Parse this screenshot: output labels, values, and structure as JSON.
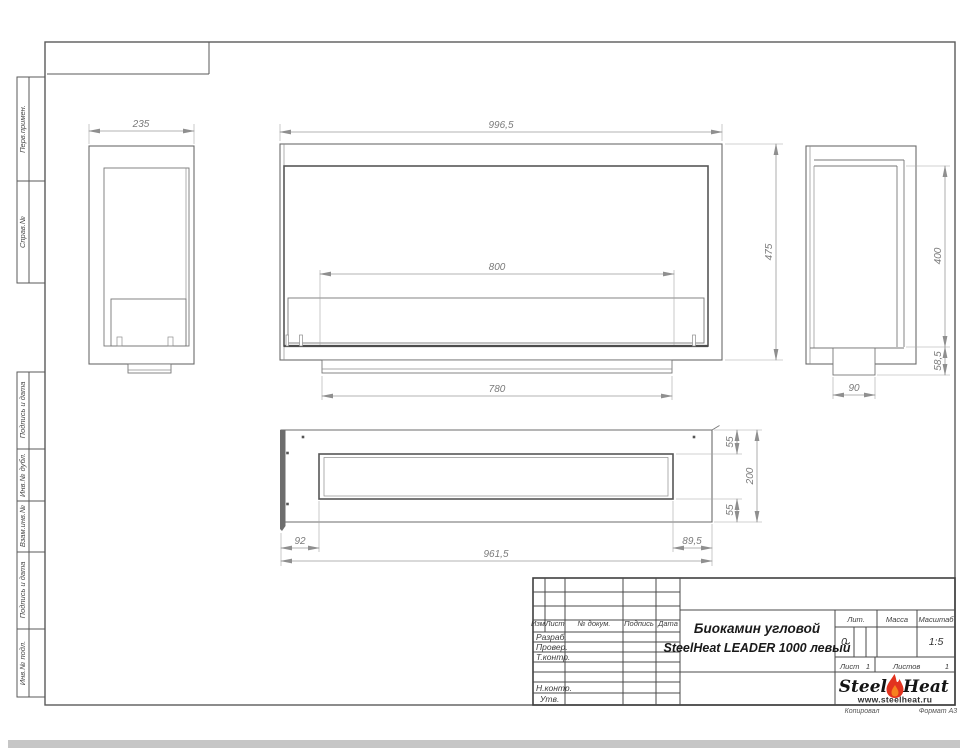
{
  "sidebar": {
    "labels": [
      "Перв.примен.",
      "Справ.№",
      "Подпись и дата",
      "Инв.№ дубл.",
      "Взам.инв.№",
      "Подпись и дата",
      "Инв.№ подл."
    ]
  },
  "dims": {
    "left_width": "235",
    "front_width": "996,5",
    "front_burner": "800",
    "front_height": "475",
    "front_base": "780",
    "side_height": "400",
    "side_bottom": "58,5",
    "side_foot": "90",
    "plan_top": "55",
    "plan_depth": "200",
    "plan_bottom": "55",
    "plan_left": "92",
    "plan_length": "961,5",
    "plan_right": "89,5"
  },
  "stamp": {
    "cols": {
      "izm": "Изм.",
      "list": "Лист",
      "doc": "№ докум.",
      "sign": "Подпись",
      "date": "Дата"
    },
    "rows": {
      "razrab": "Разраб.",
      "prover": "Провер.",
      "tkontr": "Т.контр.",
      "nkontr": "Н.контр.",
      "utv": "Утв."
    },
    "title1": "Биокамин угловой",
    "title2": "SteelHeat LEADER 1000 левый",
    "lit_label": "Лит.",
    "lit_value": "0",
    "mass_label": "Масса",
    "scale_label": "Масштаб",
    "scale_value": "1:5",
    "sheet_label": "Лист",
    "sheet_num": "1",
    "sheets_label": "Листов",
    "sheets_num": "1"
  },
  "logo": {
    "steel": "Steel",
    "heat": "Heat",
    "url": "www.steelheat.ru"
  },
  "footer": {
    "copied": "Копировал",
    "format": "Формат А3"
  },
  "colors": {
    "flame_red": "#e2331f",
    "flame_orange": "#f6821f",
    "drawing_line": "#6b6b6b",
    "dim_text": "#7a7a7a"
  }
}
